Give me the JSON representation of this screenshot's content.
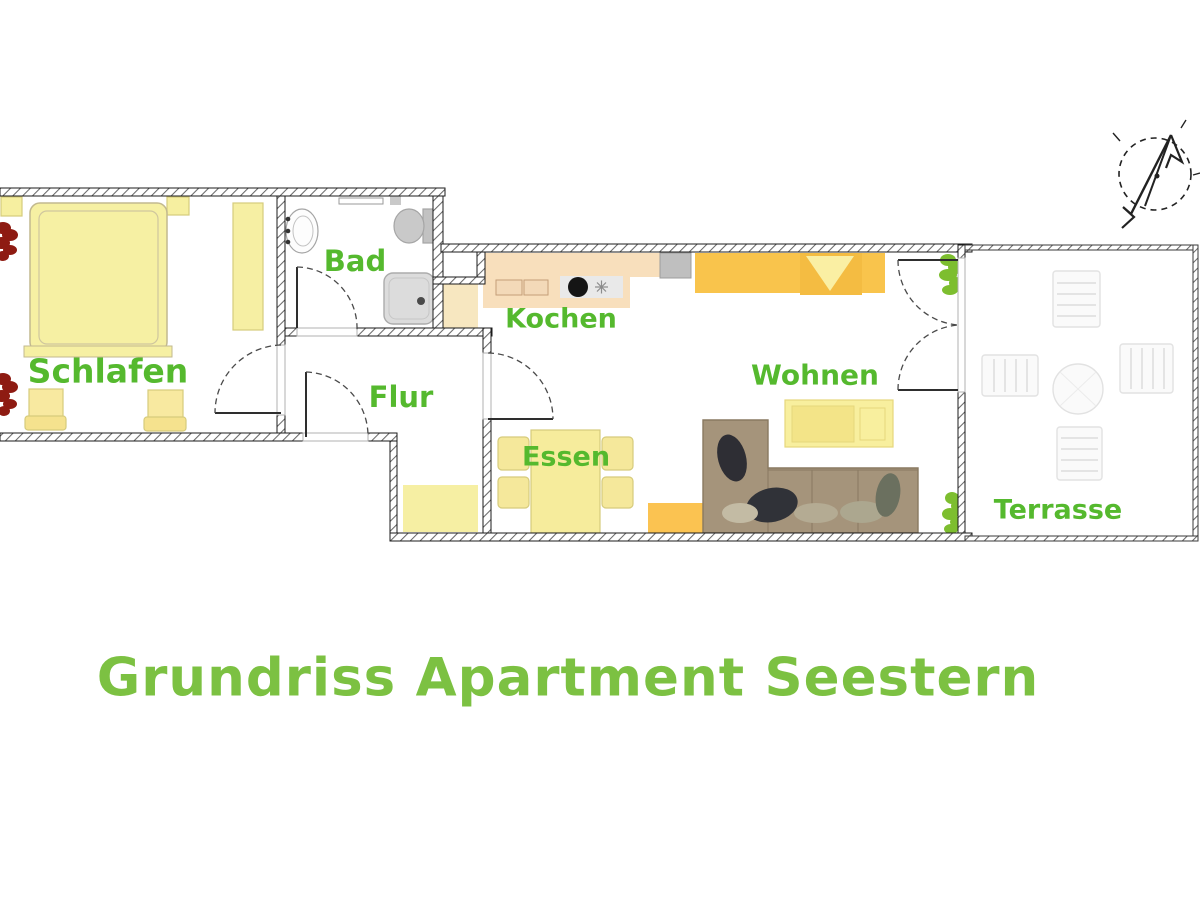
{
  "title": {
    "text": "Grundriss Apartment Seestern",
    "color": "#7cc142"
  },
  "rooms": {
    "schlafen": {
      "label": "Schlafen"
    },
    "bad": {
      "label": "Bad"
    },
    "flur": {
      "label": "Flur"
    },
    "kochen": {
      "label": "Kochen"
    },
    "wohnen": {
      "label": "Wohnen"
    },
    "essen": {
      "label": "Essen"
    },
    "terrasse": {
      "label": "Terrasse"
    }
  },
  "colors": {
    "label_green": "#55b92e",
    "title_green": "#7cc142",
    "furniture_yellow": "#f6f0a3",
    "chair_yellow": "#f8e9a0",
    "sofa_bed_orange": "#f9c44c",
    "rug_orange": "#fbc351",
    "counter_peach": "#f8dfbc",
    "cabinet_peach": "#f7e7c0",
    "corner_sofa_taupe": "#a5947b",
    "appliance_gray": "#c6c6c6",
    "plant_red": "#8e1b12",
    "plant_green": "#7dbe2f",
    "wall_dark": "#1b1b1b"
  },
  "icons": {
    "compass": "north-compass-icon"
  }
}
